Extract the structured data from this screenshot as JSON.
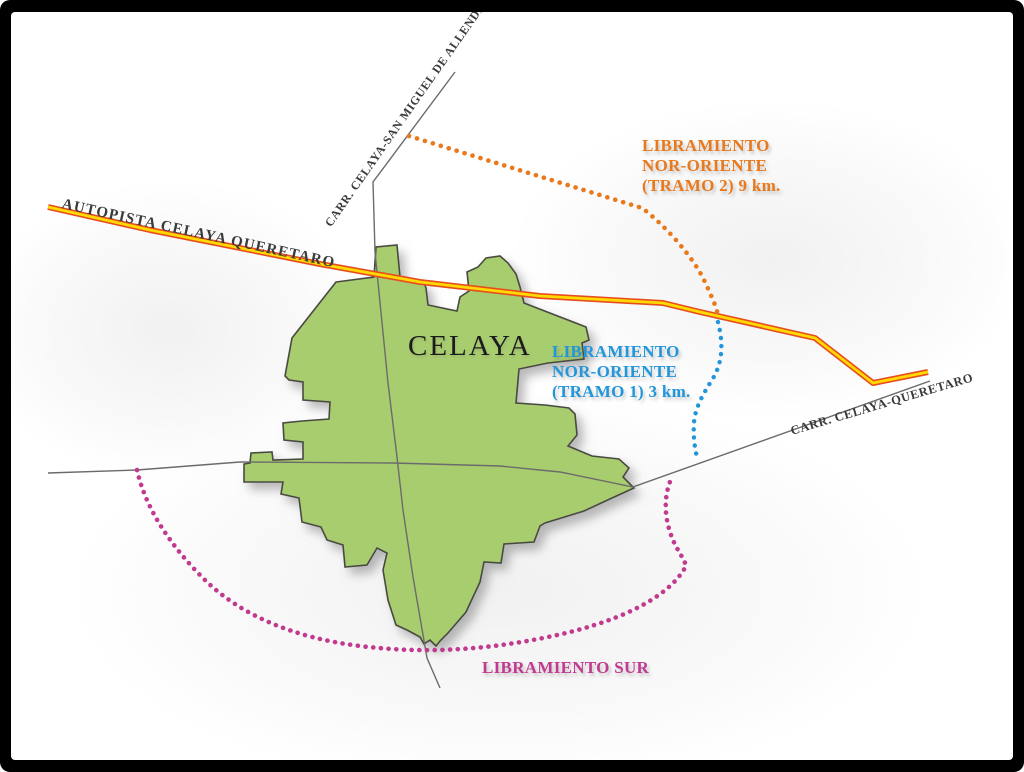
{
  "map": {
    "city": {
      "label": "CELAYA",
      "fill": "#A8CD6E",
      "stroke": "#4A4A42"
    },
    "roads": {
      "autopista_label": "AUTOPISTA CELAYA QUERETARO",
      "san_miguel_label": "CARR. CELAYA-SAN MIGUEL DE ALLENDE",
      "queretaro_label": "CARR. CELAYA-QUERETARO",
      "road_color": "#6B6B6B",
      "highway_fill": "#FFD900",
      "highway_casing": "#E64D1F",
      "label_color": "#3A3A3A"
    },
    "bypasses": {
      "nor_oriente_t2": {
        "lines": [
          "LIBRAMIENTO",
          "NOR-ORIENTE",
          "(TRAMO 2) 9 km."
        ],
        "color": "#E8791D"
      },
      "nor_oriente_t1": {
        "lines": [
          "LIBRAMIENTO",
          "NOR-ORIENTE",
          "(TRAMO 1) 3 km."
        ],
        "color": "#2196DB"
      },
      "sur": {
        "label": "LIBRAMIENTO SUR",
        "color": "#C13A90"
      }
    },
    "colors": {
      "background": "#FFFFFF",
      "frame": "#000000"
    }
  }
}
